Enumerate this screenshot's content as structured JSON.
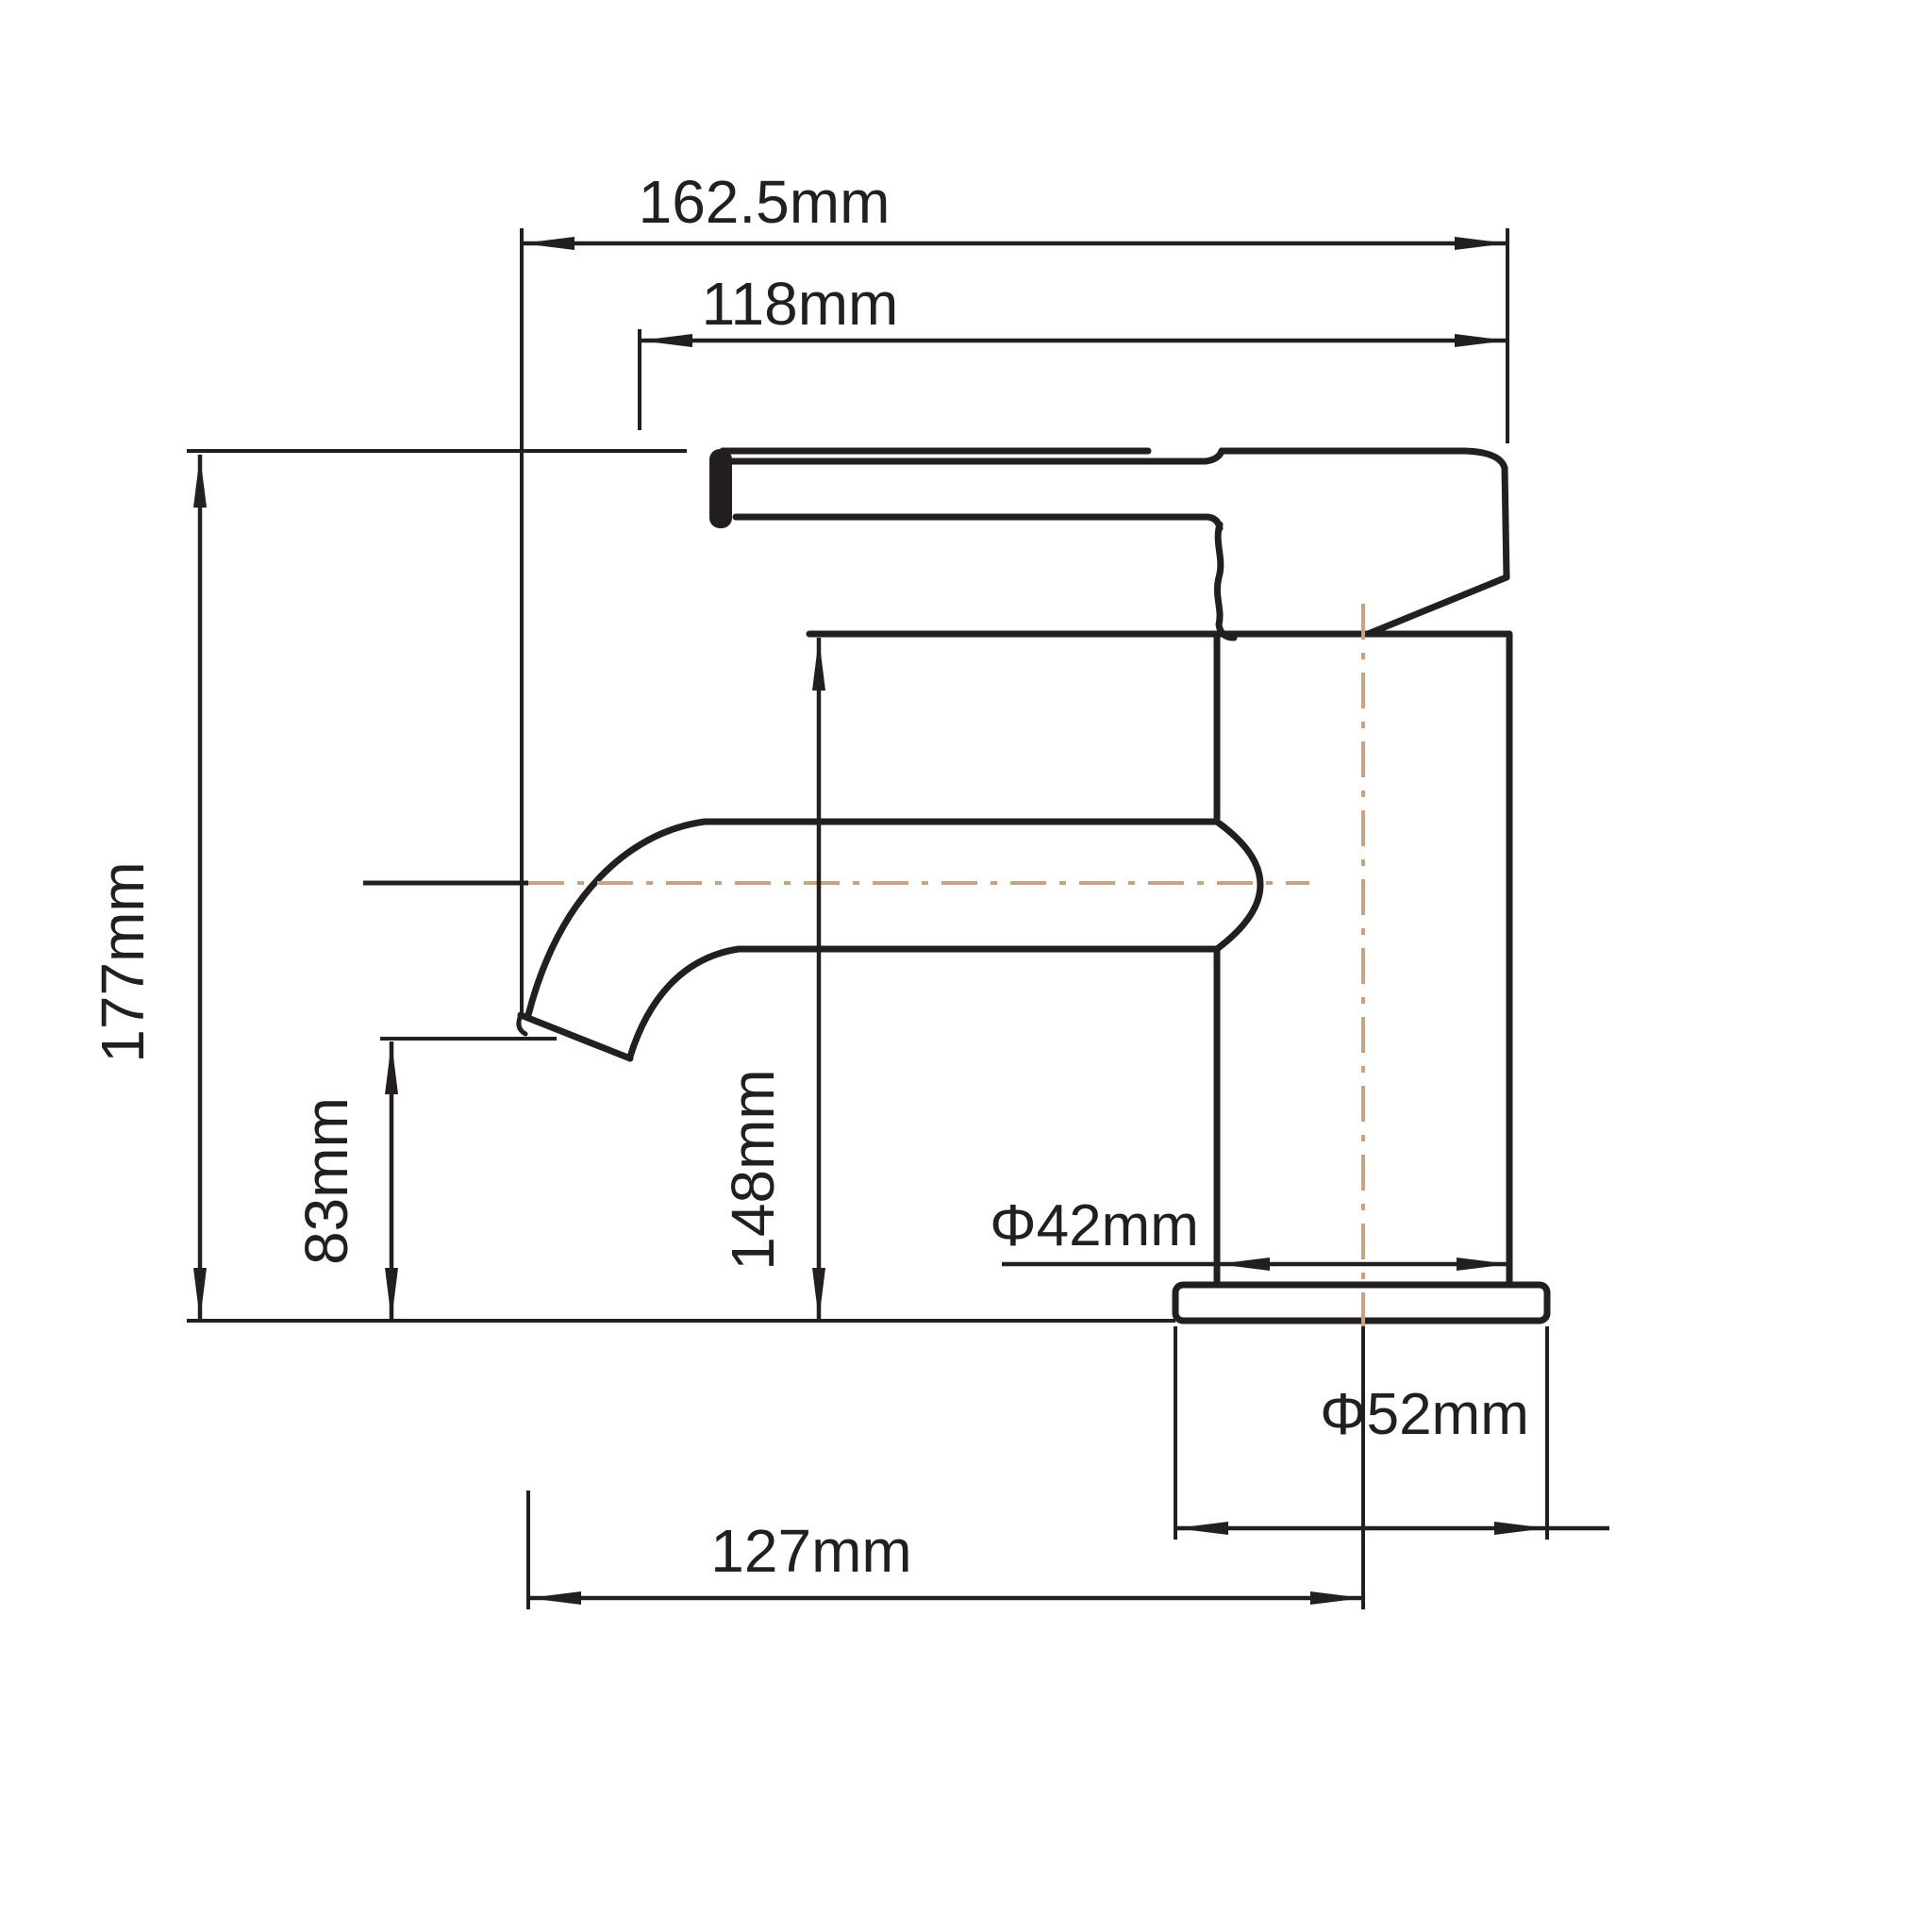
{
  "drawing": {
    "type": "faucet-dimension-drawing",
    "background_color": "#ffffff",
    "line_color": "#231f20",
    "centerline_color": "#c7a383",
    "dimensions": {
      "overall_width": {
        "label": "162.5mm"
      },
      "handle_length": {
        "label": "118mm"
      },
      "overall_height": {
        "label": "177mm"
      },
      "spout_outlet_height": {
        "label": "83mm"
      },
      "body_height": {
        "label": "148mm"
      },
      "body_diameter": {
        "label": "Φ42mm"
      },
      "base_diameter": {
        "label": "Φ52mm"
      },
      "spout_reach": {
        "label": "127mm"
      }
    }
  }
}
